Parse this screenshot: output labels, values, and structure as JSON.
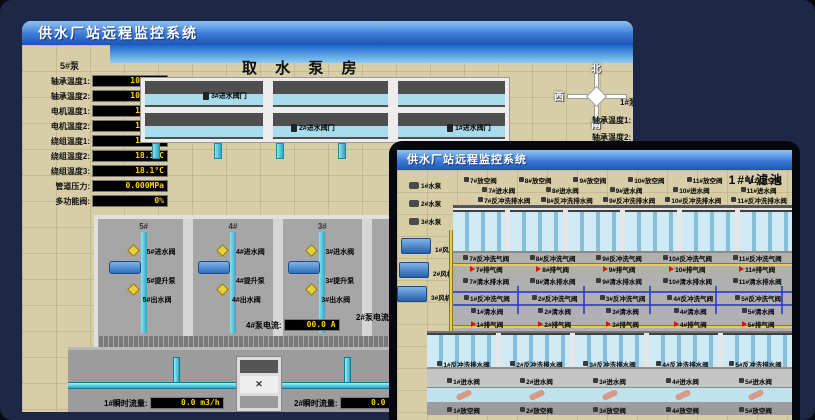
{
  "colors": {
    "desktop_bg": "#1c2846",
    "titlebar_top": "#8fc3f4",
    "titlebar_bottom": "#1e55b4",
    "readout_text": "#ffd400",
    "readout_bg": "#000000",
    "pipe_cyan": "#4ac0d8",
    "alarm_red": "#e01010",
    "pool_water": "#cfeaf4",
    "ground_tan": "#d7cda6"
  },
  "back_window": {
    "title": "供水厂站远程监控系统",
    "scene_title": "取 水 泵 房",
    "pump_panel": {
      "title": "5#泵",
      "rows": [
        {
          "label": "轴承温度1:",
          "value": "100.0°C"
        },
        {
          "label": "轴承温度2:",
          "value": "100.0°C"
        },
        {
          "label": "电机温度1:",
          "value": "18.1°C"
        },
        {
          "label": "电机温度2:",
          "value": "17.9°C"
        },
        {
          "label": "绕组温度1:",
          "value": "18.0°C"
        },
        {
          "label": "绕组温度2:",
          "value": "18.1°C"
        },
        {
          "label": "绕组温度3:",
          "value": "18.1°C"
        },
        {
          "label": "管道压力:",
          "value": "0.000MPa"
        },
        {
          "label": "多功能阀:",
          "value": "0%"
        }
      ]
    },
    "intake_valves": [
      "3#进水阀门",
      "2#进水阀门",
      "1#进水阀门"
    ],
    "compass": {
      "north": "北",
      "west": "西",
      "south": "南"
    },
    "side_panel": {
      "title": "1#泵",
      "rows": [
        "轴承温度1:",
        "轴承温度2:"
      ]
    },
    "bays": [
      {
        "no": "5#",
        "inlet": "5#进水阀",
        "pump": "5#提升泵",
        "outlet": "5#出水阀"
      },
      {
        "no": "4#",
        "inlet": "4#进水阀",
        "pump": "4#提升泵",
        "outlet": "4#出水阀"
      },
      {
        "no": "3#",
        "inlet": "3#进水阀",
        "pump": "3#提升泵",
        "outlet": "3#出水阀"
      }
    ],
    "current_readout": {
      "label": "4#泵电流:",
      "value": "00.0 A"
    },
    "current_readout_partial": "2#泵电流",
    "flow_readouts": [
      {
        "label": "1#瞬时流量:",
        "value": "0.0 m3/h"
      },
      {
        "label": "2#瞬时流量:",
        "value": "0.0 m3/h"
      }
    ]
  },
  "front_window": {
    "title": "供水厂站远程监控系统",
    "scene_title": "1#V滤池",
    "equipment": {
      "pumps": [
        "1#水泵",
        "2#水泵",
        "3#水泵"
      ],
      "blowers": [
        "1#风机",
        "2#风机",
        "3#风机"
      ]
    },
    "valve_rows": {
      "vent_back": [
        "7#放空阀",
        "8#放空阀",
        "9#放空阀",
        "10#放空阀",
        "11#放空阀",
        "12#放空阀"
      ],
      "inlet_back": [
        "7#进水阀",
        "8#进水阀",
        "9#进水阀",
        "10#进水阀",
        "11#进水阀"
      ],
      "bwdrain_back": [
        "7#反冲洗排水阀",
        "8#反冲洗排水阀",
        "9#反冲洗排水阀",
        "10#反冲洗排水阀",
        "11#反冲洗排水阀"
      ],
      "air_back": [
        "7#反冲洗气阀",
        "8#反冲洗气阀",
        "9#反冲洗气阀",
        "10#反冲洗气阀",
        "11#反冲洗气阀"
      ],
      "exhaust_back": [
        "7#排气阀",
        "8#排气阀",
        "9#排气阀",
        "10#排气阀",
        "11#排气阀"
      ],
      "cleandrain_back": [
        "7#清水排水阀",
        "8#清水排水阀",
        "9#清水排水阀",
        "10#清水排水阀",
        "11#清水排水阀"
      ],
      "air_front": [
        "1#反冲洗气阀",
        "2#反冲洗气阀",
        "3#反冲洗气阀",
        "4#反冲洗气阀",
        "5#反冲洗气阀"
      ],
      "clean_front": [
        "1#清水阀",
        "2#清水阀",
        "3#清水阀",
        "4#清水阀",
        "5#清水阀"
      ],
      "exhaust_front": [
        "1#排气阀",
        "2#排气阀",
        "3#排气阀",
        "4#排气阀",
        "5#排气阀"
      ],
      "bwdrain_front": [
        "1#反冲洗排水阀",
        "2#反冲洗排水阀",
        "3#反冲洗排水阀",
        "4#反冲洗排水阀",
        "5#反冲洗排水阀"
      ],
      "inlet_front": [
        "1#进水阀",
        "2#进水阀",
        "3#进水阀",
        "4#进水阀",
        "5#进水阀"
      ],
      "vent_front": [
        "1#放空阀",
        "2#放空阀",
        "3#放空阀",
        "4#放空阀",
        "5#放空阀"
      ]
    }
  }
}
